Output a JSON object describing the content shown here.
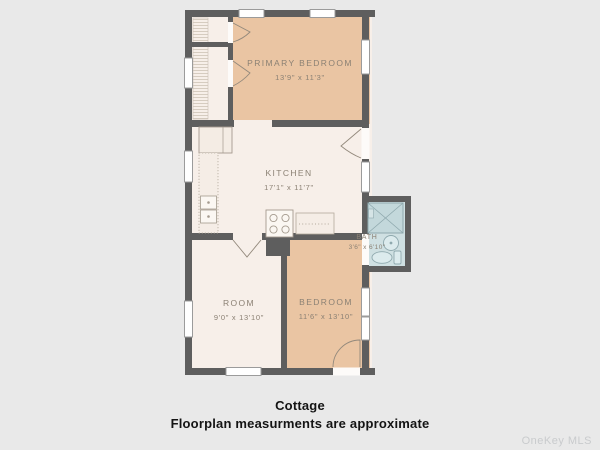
{
  "floorplan": {
    "rooms": [
      {
        "name": "PRIMARY BEDROOM",
        "dims": "13'9\" x 11'3\""
      },
      {
        "name": "KITCHEN",
        "dims": "17'1\" x 11'7\""
      },
      {
        "name": "BATH",
        "dims": "3'6\" x 6'10\""
      },
      {
        "name": "ROOM",
        "dims": "9'0\" x 13'10\""
      },
      {
        "name": "BEDROOM",
        "dims": "11'6\" x 13'10\""
      }
    ],
    "colors": {
      "background": "#e9e9e9",
      "wall": "#5e5e5e",
      "floor_cream": "#f7efe9",
      "floor_tan": "#eac5a3",
      "bath_blue": "#cfe0e2",
      "fixture_line": "#a49a8e",
      "bath_fixture_line": "#8fa9ae",
      "window_fill": "#ffffff",
      "label_text": "#8b8174"
    }
  },
  "caption": {
    "title": "Cottage",
    "subtitle": "Floorplan measurments are approximate"
  },
  "watermark": "OneKey MLS"
}
